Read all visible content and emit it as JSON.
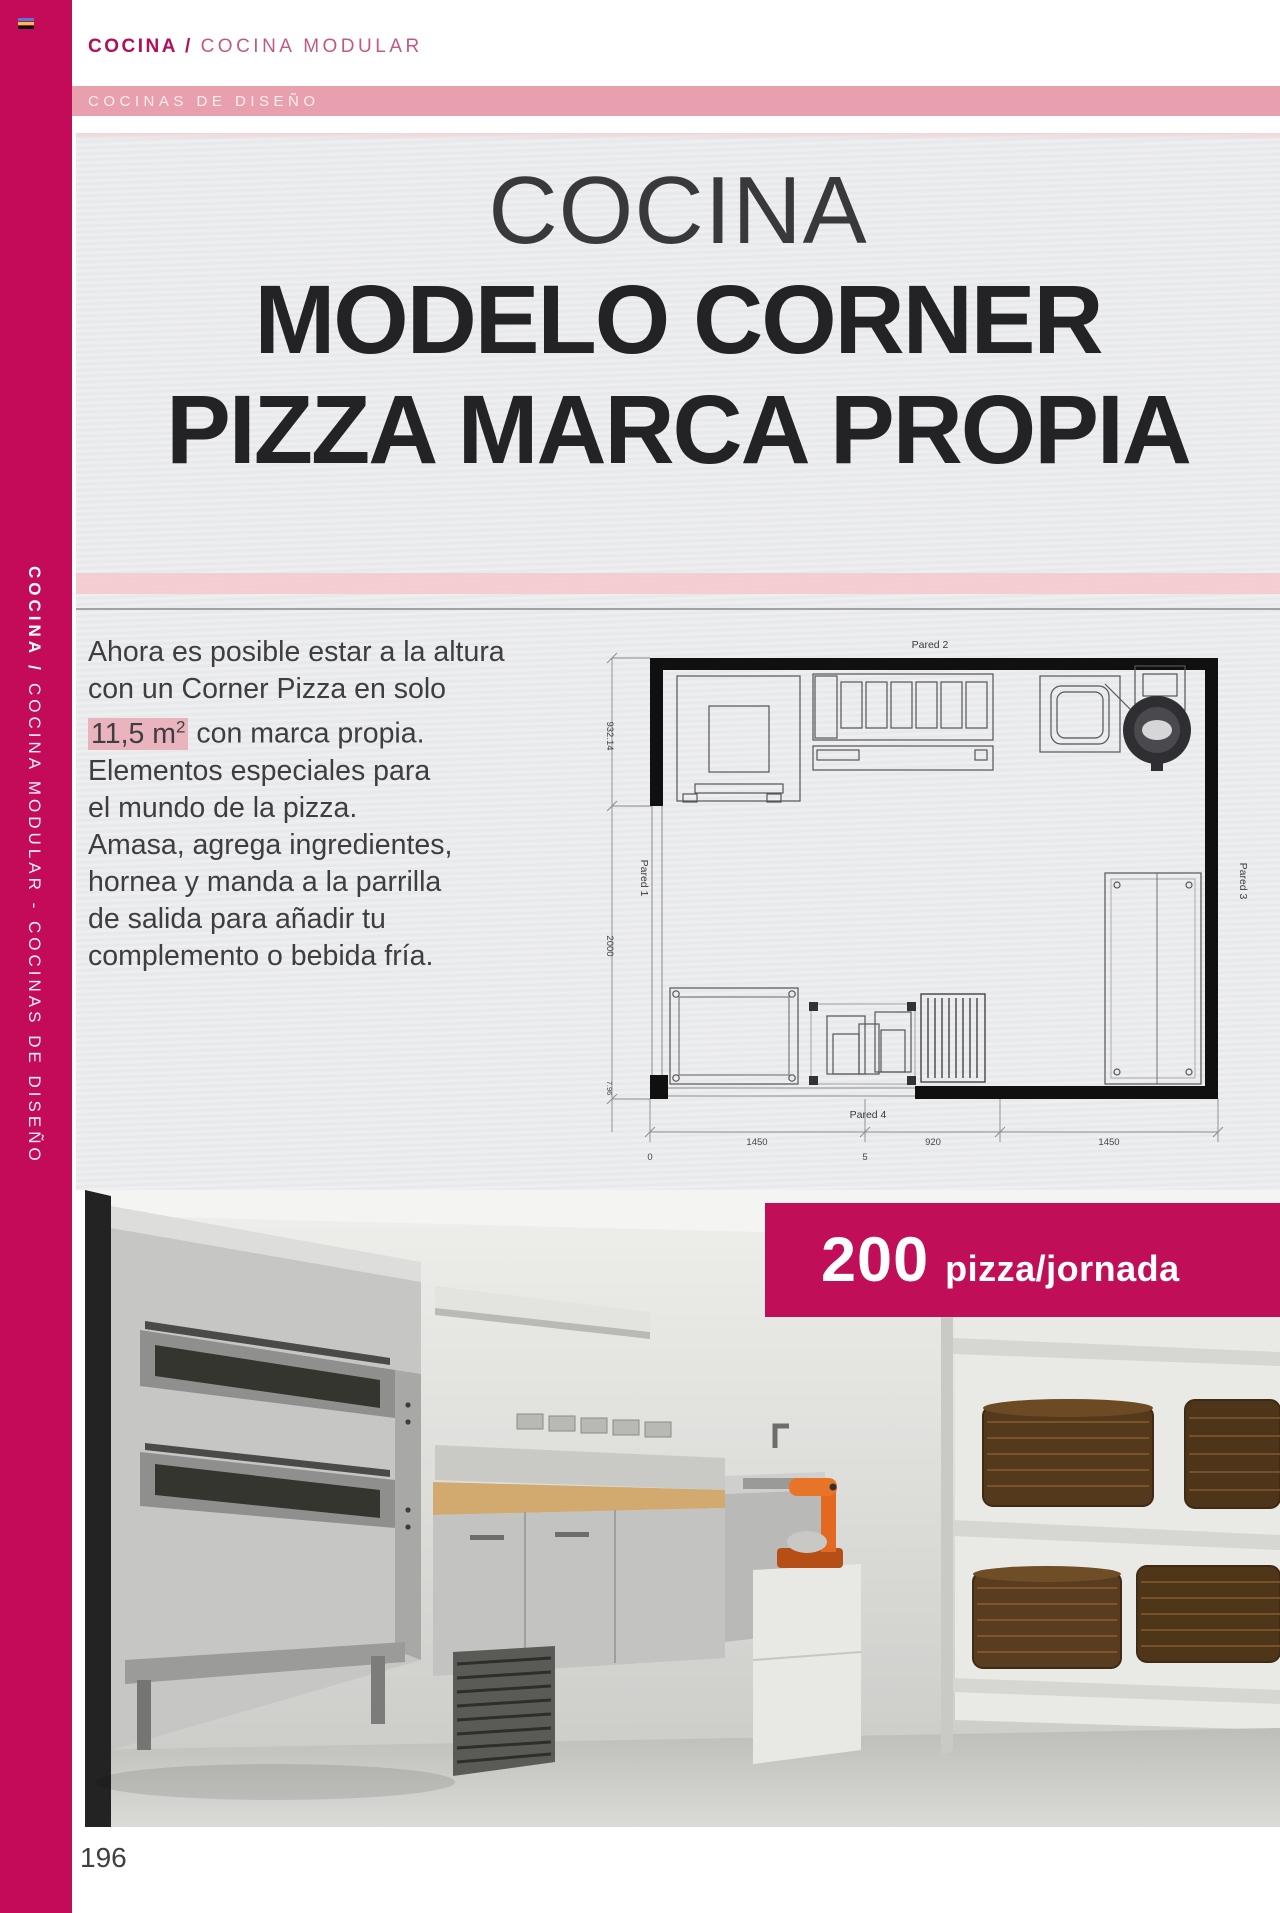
{
  "rail": {
    "vertical_bold": "COCINA / ",
    "vertical_rest": "COCINA MODULAR - COCINAS DE DISEÑO"
  },
  "breadcrumb": {
    "section": "COCINA / ",
    "subsection": "COCINA MODULAR"
  },
  "category_bar": {
    "label": "COCINAS DE DISEÑO"
  },
  "hero": {
    "line1": "COCINA",
    "line2": "MODELO CORNER",
    "line3": "PIZZA MARCA PROPIA"
  },
  "intro": {
    "line1": "Ahora es posible estar a la altura",
    "line2": "con un Corner Pizza en solo",
    "line3_highlight": "11,5 m",
    "line3_sup": "2",
    "line3_rest": " con marca propia.",
    "line4": "Elementos especiales para",
    "line5": "el mundo de la pizza.",
    "line6": "Amasa, agrega ingredientes,",
    "line7": "hornea y manda a la parrilla",
    "line8": "de salida para añadir tu",
    "line9": "complemento o bebida fría."
  },
  "floor_plan": {
    "wall_top": "Pared 2",
    "wall_left": "Pared 1",
    "wall_right": "Pared 3",
    "wall_bottom": "Pared 4",
    "dim_left_top": "932.14",
    "dim_left_bottom": "2000",
    "dim_left_small": "7.96",
    "dim_bottom_left": "1450",
    "dim_bottom_center": "920",
    "dim_bottom_right": "1450",
    "scale_zero": "0",
    "scale_five": "5"
  },
  "badge": {
    "value": "200",
    "unit": "pizza/jornada"
  },
  "page": {
    "number": "196"
  },
  "colors": {
    "magenta": "#c30b59",
    "pink_bar": "#e8a0ae",
    "pink_band": "#f4c8ce",
    "highlight": "#e9b4be"
  }
}
